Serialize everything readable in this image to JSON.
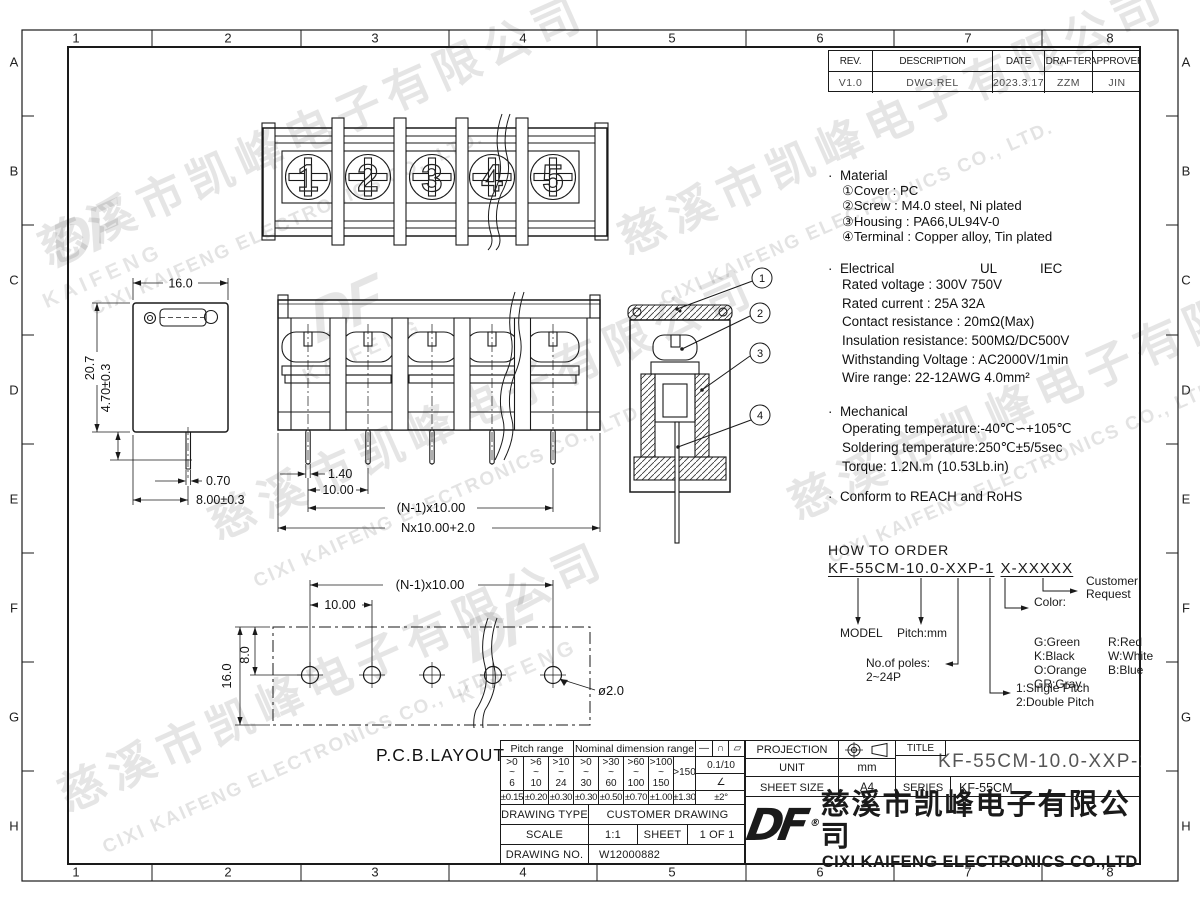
{
  "grid": {
    "cols": [
      "1",
      "2",
      "3",
      "4",
      "5",
      "6",
      "7",
      "8"
    ],
    "rows": [
      "A",
      "B",
      "C",
      "D",
      "E",
      "F",
      "G",
      "H"
    ]
  },
  "revision": {
    "headers": [
      "REV.",
      "DESCRIPTION",
      "DATE",
      "DRAFTER",
      "APPROVER"
    ],
    "values": [
      "V1.0",
      "DWG.REL",
      "2023.3.17",
      "ZZM",
      "JIN"
    ]
  },
  "views": {
    "top": {
      "pole_numbers": [
        "1",
        "2",
        "3",
        "4",
        "5"
      ]
    },
    "side": {
      "dim_width": "16.0",
      "dim_height": "20.7",
      "dim_470": "4.70±0.3",
      "dim_pin": "0.70",
      "dim_800": "8.00±0.3"
    },
    "front": {
      "dim_pin": "1.40",
      "dim_pitch": "10.00",
      "dim_n1": "(N-1)x10.00",
      "dim_total": "Nx10.00+2.0"
    },
    "section": {
      "callouts": [
        "1",
        "2",
        "3",
        "4"
      ]
    },
    "pcb": {
      "label": "P.C.B.LAYOUT",
      "dim_n1": "(N-1)x10.00",
      "dim_pitch": "10.00",
      "dim_8": "8.0",
      "dim_16": "16.0",
      "dim_hole": "ø2.0"
    }
  },
  "notes": {
    "material_title": "Material",
    "material": [
      "①Cover : PC",
      "②Screw : M4.0 steel, Ni plated",
      "③Housing : PA66,UL94V-0",
      "④Terminal : Copper alloy, Tin plated"
    ],
    "electrical_title": "Electrical",
    "electrical_ul": "UL",
    "electrical_iec": "IEC",
    "electrical": [
      "Rated voltage : 300V  750V",
      "Rated current : 25A   32A",
      "Contact resistance : 20mΩ(Max)",
      "Insulation resistance: 500MΩ/DC500V",
      "Withstanding Voltage : AC2000V/1min",
      "Wire range: 22-12AWG  4.0mm²"
    ],
    "mechanical_title": "Mechanical",
    "mechanical": [
      "Operating temperature:-40℃∽+105℃",
      "Soldering temperature:250℃±5/5sec",
      "Torque: 1.2N.m (10.53Lb.in)"
    ],
    "conform": "Conform to REACH and RoHS"
  },
  "order": {
    "title": "HOW TO ORDER",
    "code_a": "KF-55CM-10.0-XXP-1",
    "code_b": "X-XXXXX",
    "model_label": "MODEL",
    "pitch_label": "Pitch:mm",
    "poles_label": "No.of poles:",
    "poles_value": "2~24P",
    "pitch_type_1": "1:Single Pitch",
    "pitch_type_2": "2:Double Pitch",
    "color_label": "Color:",
    "colors": [
      "G:Green",
      "R:Red",
      "K:Black",
      "W:White",
      "O:Orange",
      "B:Blue",
      "GR:Gray"
    ],
    "customer_1": "Customer",
    "customer_2": "Request"
  },
  "tolerance_table": {
    "pitch_header": "Pitch range",
    "nominal_header": "Nominal dimension range",
    "symbols": [
      "—",
      "∩",
      "▱"
    ],
    "ranges": [
      ">0\n~\n6",
      ">6\n~\n10",
      ">10\n~\n24",
      ">0\n~\n30",
      ">30\n~\n60",
      ">60\n~\n100",
      ">100\n~\n150"
    ],
    "range_last": ">150",
    "flatness": "0.1/10",
    "angle_symbol": "∠",
    "tolerances": [
      "±0.15",
      "±0.20",
      "±0.30",
      "±0.30",
      "±0.50",
      "±0.70",
      "±1.00",
      "±1.30"
    ],
    "angle_tolerance": "±2°"
  },
  "title_block": {
    "projection_label": "PROJECTION",
    "unit_label": "UNIT",
    "unit_value": "mm",
    "sheet_size_label": "SHEET SIZE",
    "sheet_size_value": "A4",
    "title_label": "TITLE",
    "title_value": "KF-55CM-10.0-XXP-1X",
    "series_label": "SERIES",
    "series_value": "KF-55CM"
  },
  "drawing_block": {
    "type_label": "DRAWING TYPE",
    "type_value": "CUSTOMER DRAWING",
    "scale_label": "SCALE",
    "scale_value": "1:1",
    "sheet_label": "SHEET",
    "sheet_value": "1 OF 1",
    "no_label": "DRAWING NO.",
    "no_value": "W12000882"
  },
  "company": {
    "logo": "DF",
    "reg": "®",
    "name_cn": "慈溪市凯峰电子有限公司",
    "name_en": "CIXI KAIFENG ELECTRONICS CO.,LTD"
  },
  "watermark": {
    "cn": "慈溪市凯峰电子有限公司",
    "en": "CIXI KAIFENG ELECTRONICS CO., LTD.",
    "logo": "DF",
    "logo_text": "KAIFENG"
  }
}
